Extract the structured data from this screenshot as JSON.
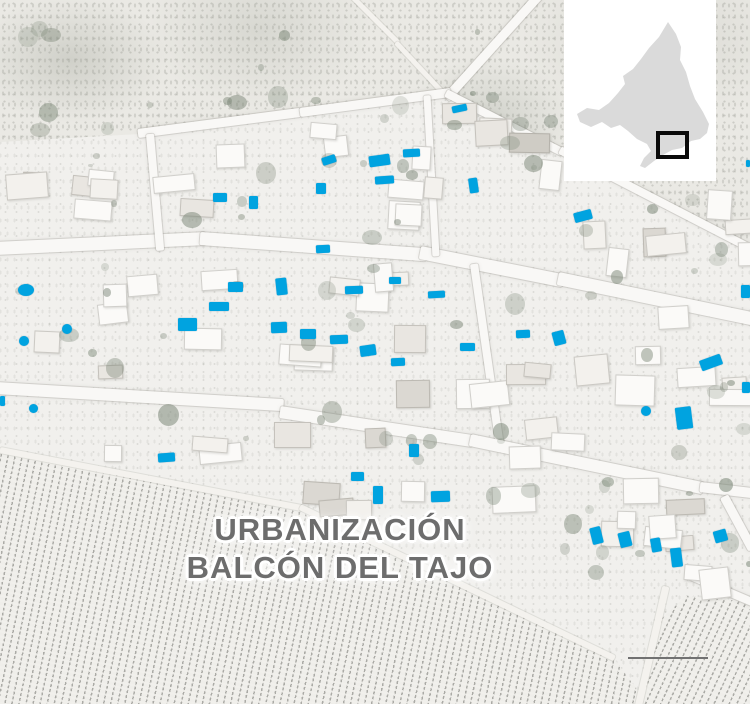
{
  "map": {
    "type": "aerial-photo-locator-map",
    "labels": {
      "urbanization_line1": "URBANIZACIÓN",
      "urbanization_line2": "BALCÓN DEL TAJO"
    },
    "colors": {
      "pool": "#00A3E0",
      "label_text": "#6D6D6D",
      "inset_background": "#FFFFFF",
      "inset_region_fill": "#DADADA",
      "inset_marker_stroke": "#0A0A0A",
      "scale_bar": "#717171"
    },
    "inset": {
      "region_shape": "community-of-madrid-silhouette",
      "marker_box": {
        "x": 94,
        "y": 133,
        "w": 29,
        "h": 24
      }
    },
    "scale_bar": {
      "length_px": 80
    },
    "pools": {
      "description": "highlighted swimming pools",
      "columns": [
        "x",
        "y",
        "w",
        "h",
        "rotation_deg",
        "shape"
      ],
      "items": [
        [
          452,
          105,
          15,
          7,
          -12,
          "r"
        ],
        [
          322,
          156,
          14,
          8,
          -18,
          "r"
        ],
        [
          369,
          155,
          21,
          11,
          -8,
          "r"
        ],
        [
          403,
          149,
          17,
          8,
          -3,
          "r"
        ],
        [
          316,
          183,
          10,
          11,
          0,
          "r"
        ],
        [
          375,
          176,
          19,
          8,
          -4,
          "r"
        ],
        [
          469,
          178,
          9,
          15,
          -8,
          "r"
        ],
        [
          213,
          193,
          14,
          9,
          0,
          "r"
        ],
        [
          249,
          196,
          9,
          13,
          0,
          "r"
        ],
        [
          18,
          284,
          16,
          12,
          0,
          "c"
        ],
        [
          62,
          324,
          10,
          10,
          0,
          "c"
        ],
        [
          19,
          336,
          10,
          10,
          0,
          "c"
        ],
        [
          228,
          282,
          15,
          10,
          0,
          "r"
        ],
        [
          209,
          302,
          20,
          9,
          0,
          "r"
        ],
        [
          178,
          318,
          19,
          13,
          0,
          "r"
        ],
        [
          276,
          278,
          11,
          17,
          -6,
          "r"
        ],
        [
          316,
          245,
          14,
          8,
          -3,
          "r"
        ],
        [
          389,
          277,
          12,
          7,
          0,
          "r"
        ],
        [
          345,
          286,
          18,
          8,
          -2,
          "r"
        ],
        [
          428,
          291,
          17,
          7,
          -3,
          "r"
        ],
        [
          300,
          329,
          16,
          10,
          0,
          "r"
        ],
        [
          330,
          335,
          18,
          9,
          -2,
          "r"
        ],
        [
          360,
          345,
          16,
          11,
          -8,
          "r"
        ],
        [
          391,
          358,
          14,
          8,
          -2,
          "r"
        ],
        [
          460,
          343,
          15,
          8,
          0,
          "r"
        ],
        [
          516,
          330,
          14,
          8,
          -2,
          "r"
        ],
        [
          271,
          322,
          16,
          11,
          -2,
          "r"
        ],
        [
          574,
          211,
          18,
          10,
          -15,
          "r"
        ],
        [
          741,
          285,
          9,
          13,
          0,
          "r"
        ],
        [
          553,
          331,
          12,
          14,
          -15,
          "r"
        ],
        [
          700,
          357,
          22,
          11,
          -20,
          "r"
        ],
        [
          742,
          382,
          8,
          11,
          0,
          "r"
        ],
        [
          641,
          406,
          10,
          10,
          0,
          "c"
        ],
        [
          746,
          160,
          4,
          7,
          0,
          "r"
        ],
        [
          676,
          407,
          16,
          22,
          -7,
          "r"
        ],
        [
          591,
          527,
          11,
          17,
          -14,
          "r"
        ],
        [
          619,
          532,
          12,
          15,
          -14,
          "r"
        ],
        [
          651,
          538,
          10,
          14,
          -10,
          "r"
        ],
        [
          671,
          548,
          11,
          19,
          -7,
          "r"
        ],
        [
          714,
          530,
          13,
          12,
          -16,
          "r"
        ],
        [
          29,
          404,
          9,
          9,
          0,
          "c"
        ],
        [
          0,
          396,
          5,
          10,
          0,
          "r"
        ],
        [
          158,
          453,
          17,
          9,
          -4,
          "r"
        ],
        [
          409,
          444,
          10,
          13,
          0,
          "r"
        ],
        [
          351,
          472,
          13,
          9,
          0,
          "r"
        ],
        [
          373,
          486,
          10,
          18,
          0,
          "r"
        ],
        [
          431,
          491,
          19,
          11,
          -2,
          "r"
        ]
      ]
    }
  }
}
